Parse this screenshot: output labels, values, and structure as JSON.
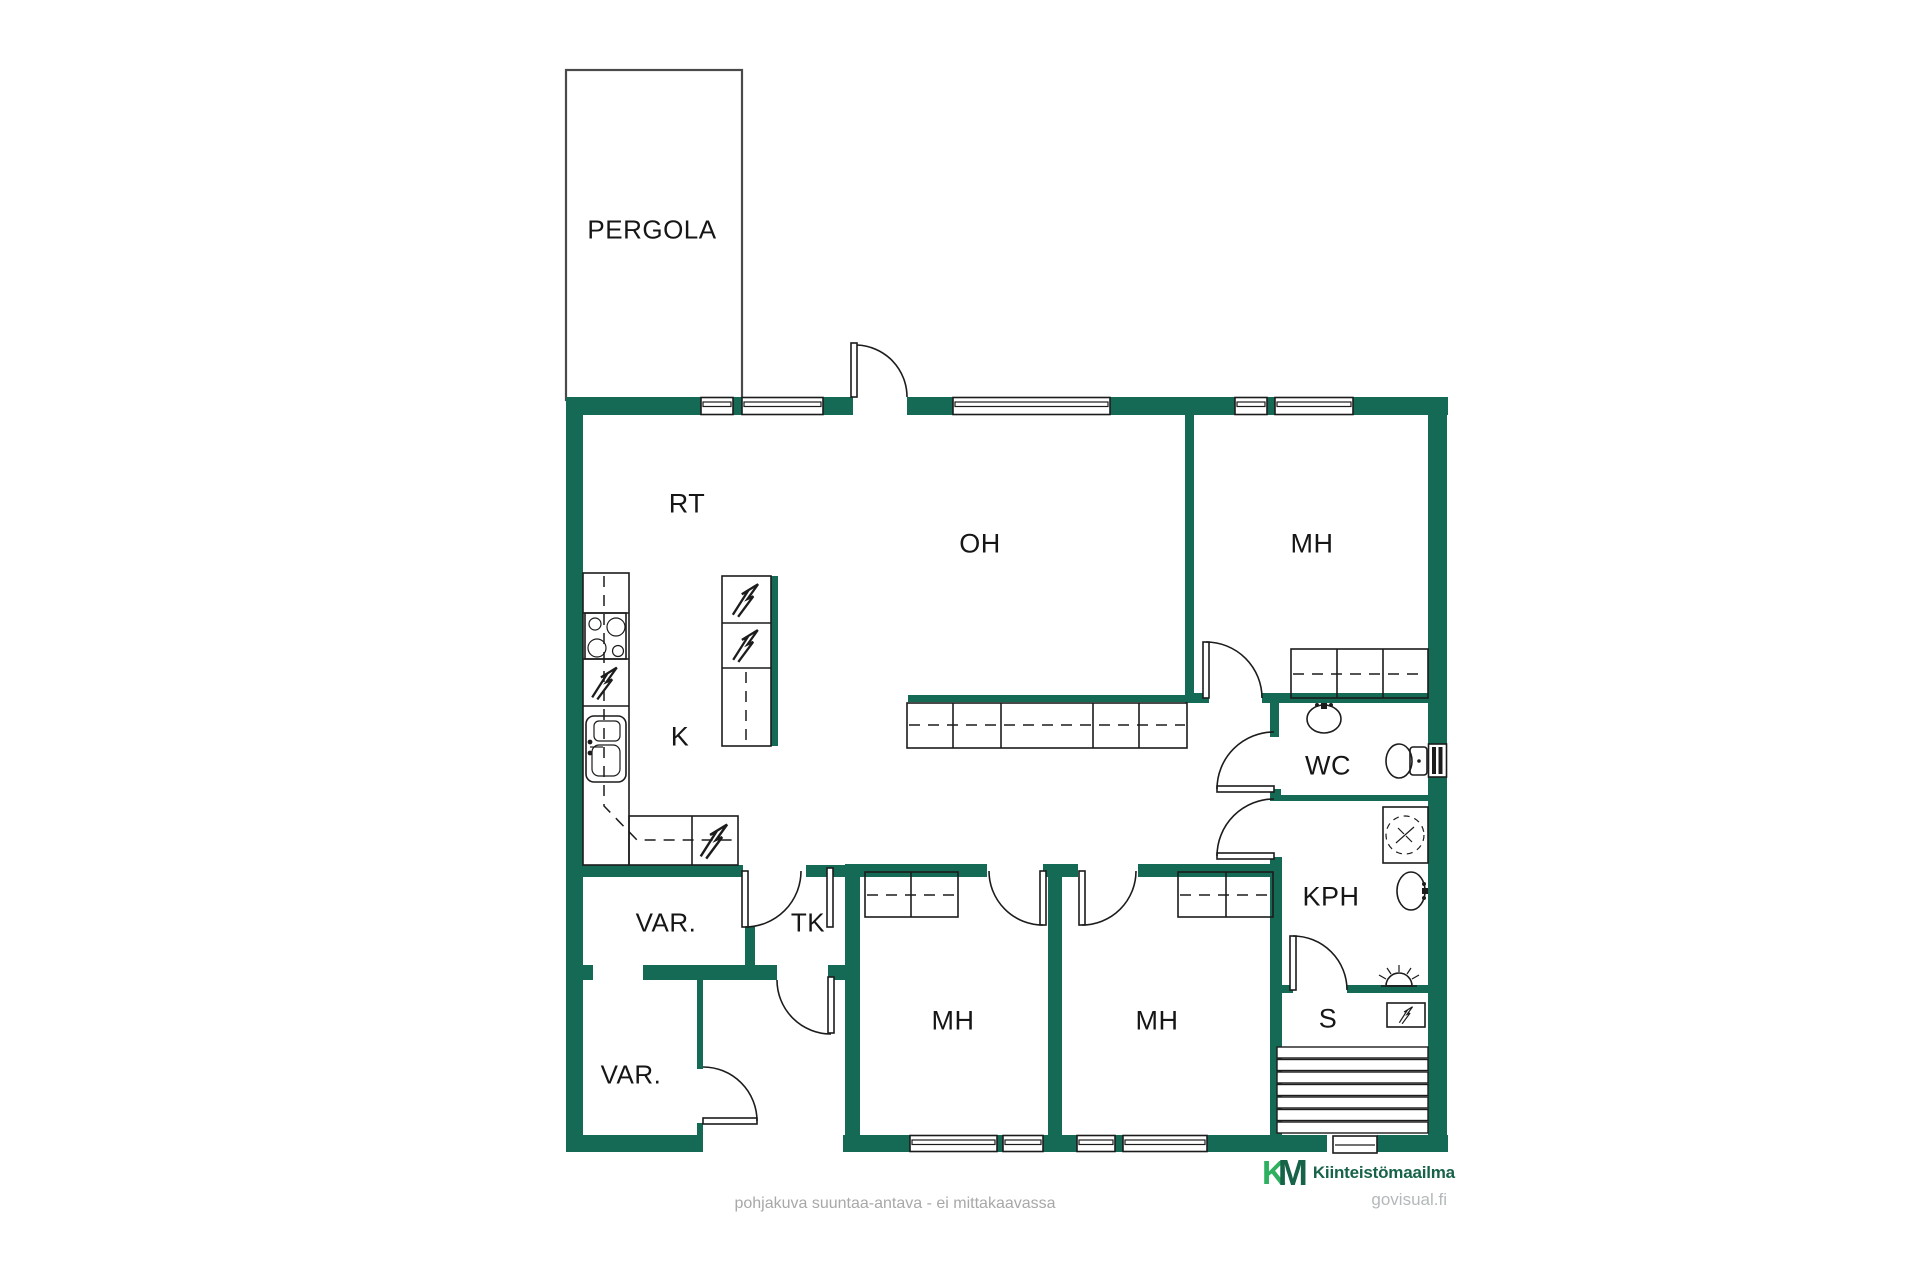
{
  "rooms": {
    "pergola": "PERGOLA",
    "rt": "RT",
    "oh": "OH",
    "mh_top": "MH",
    "k": "K",
    "wc": "WC",
    "kph": "KPH",
    "var_upper": "VAR.",
    "tk": "TK",
    "mh_left": "MH",
    "mh_right": "MH",
    "s": "S",
    "var_lower": "VAR."
  },
  "footer": {
    "caption": "pohjakuva suuntaa-antava - ei mittakaavassa",
    "logo_k": "K",
    "logo_m": "M",
    "brand": "Kiinteistömaailma",
    "site": "govisual.fi"
  },
  "colors": {
    "wall": "#156a55",
    "line": "#1c1c1c",
    "caption": "#a8a8a8",
    "brand_green": "#17634a",
    "logo_bright": "#2fb061",
    "site_gray": "#b3b8ba"
  }
}
